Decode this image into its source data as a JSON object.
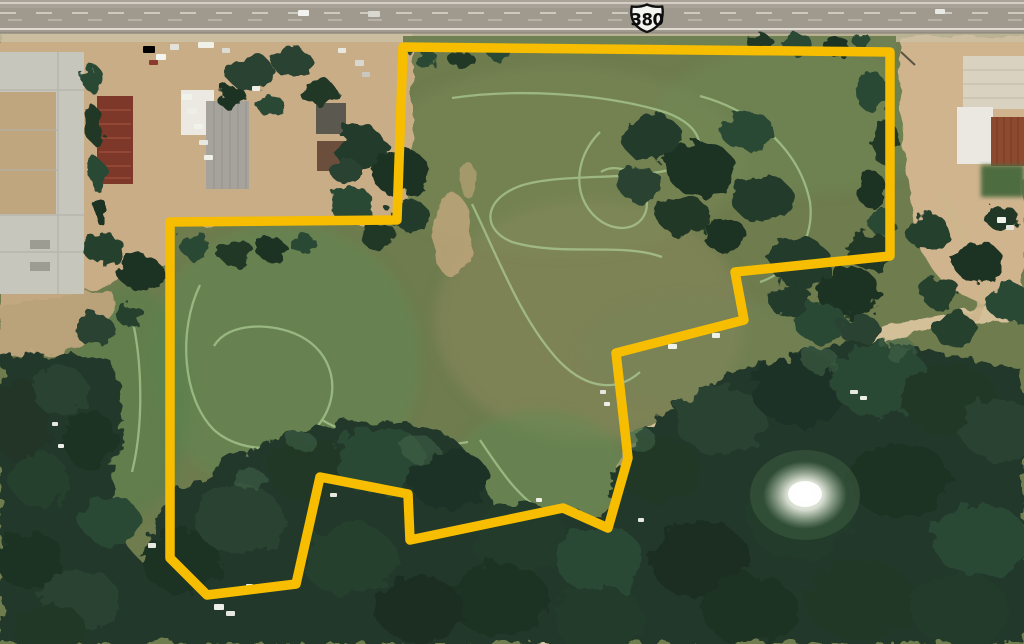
{
  "scene": {
    "route_shield": {
      "label": "380"
    },
    "boundary": {
      "color": "#F7BD00",
      "stroke_width": 9.5
    },
    "palette": {
      "field_green": "#6E7C4E",
      "forest_green": "#23382A",
      "dirt_tan": "#C9AD86",
      "highway_gray": "#A09A8E",
      "concrete_pad": "#C6C6BC",
      "red_roof": "#7D382A",
      "rust_roof": "#8C4A2F",
      "pond_glare": "#FFFFFF"
    }
  }
}
